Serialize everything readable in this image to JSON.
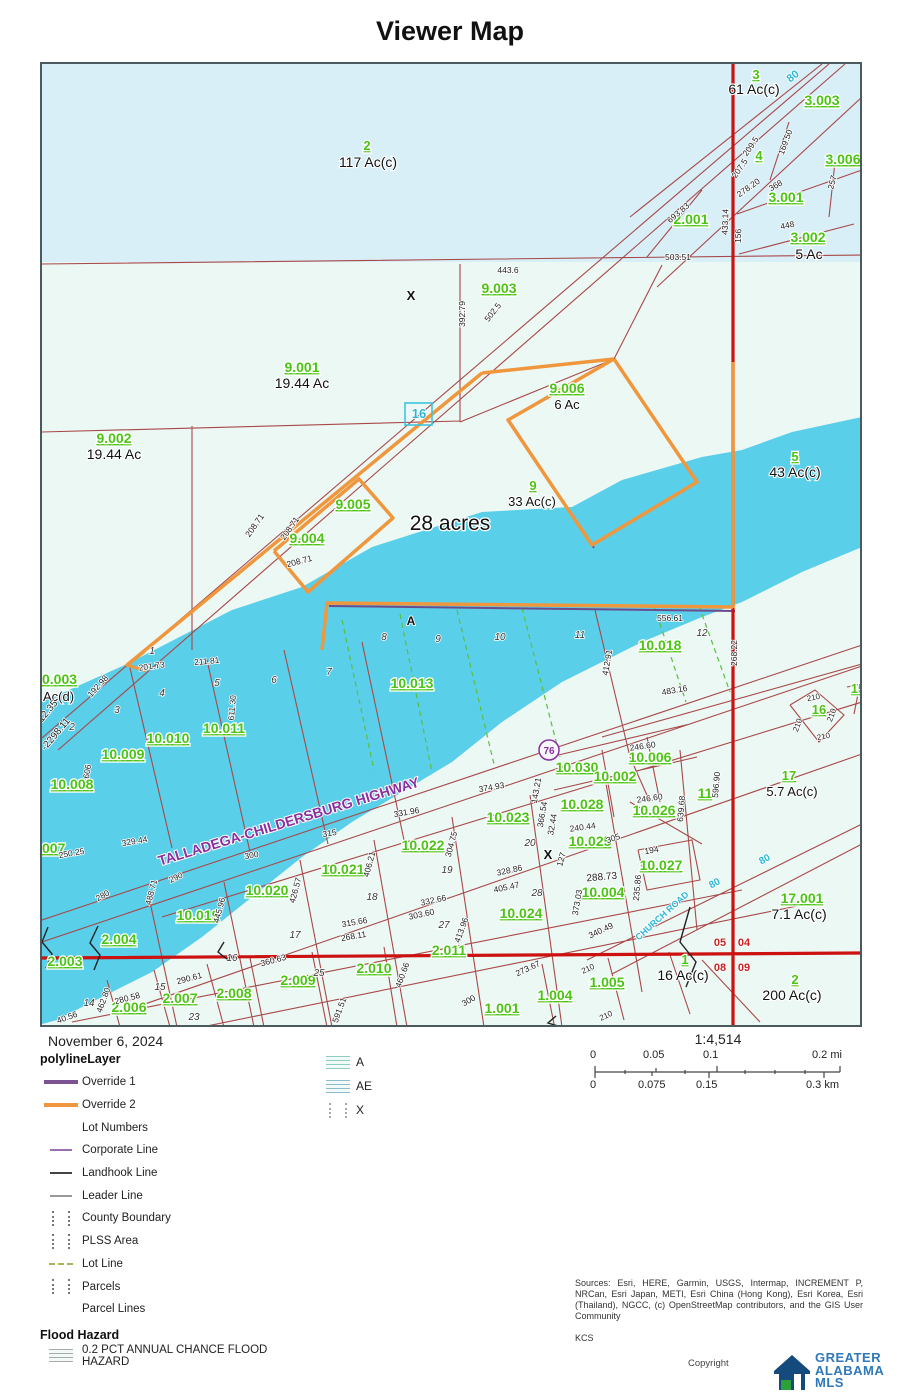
{
  "title": "Viewer Map",
  "map": {
    "colors": {
      "water": "#59cfea",
      "land": "#ecf8f4",
      "land_top": "#d9eff8",
      "parcel_line": "#a84848",
      "road_red": "#cc1111",
      "override1": "#6b4d8e",
      "override2": "#f0963c",
      "lot_line_green": "#5abf3f",
      "label_green": "#4cc414",
      "road_label_cyan": "#29b6d8",
      "highway_label_purple": "#8b2fa0"
    },
    "labels": [
      [
        "3",
        754,
        77,
        "g",
        13
      ],
      [
        "3.003",
        820,
        103,
        "g",
        14
      ],
      [
        "2",
        365,
        148,
        "g",
        13
      ],
      [
        "4",
        757,
        158,
        "g",
        13
      ],
      [
        "3.001",
        784,
        200,
        "g",
        14
      ],
      [
        "2.001",
        689,
        222,
        "g",
        14
      ],
      [
        "3.002",
        806,
        240,
        "g",
        14
      ],
      [
        "3.006",
        841,
        162,
        "g",
        14
      ],
      [
        "9.003",
        497,
        291,
        "g",
        14
      ],
      [
        "9.001",
        300,
        370,
        "g",
        14
      ],
      [
        "9.002",
        112,
        441,
        "g",
        14
      ],
      [
        "9.006",
        565,
        391,
        "g",
        14
      ],
      [
        "9.005",
        351,
        507,
        "g",
        14
      ],
      [
        "9.004",
        305,
        541,
        "g",
        14
      ],
      [
        "9",
        531,
        488,
        "g",
        13
      ],
      [
        "5",
        793,
        459,
        "g",
        13
      ],
      [
        "0.003",
        40,
        682,
        "g",
        14,
        0,
        "s"
      ],
      [
        "007",
        40,
        851,
        "g",
        14,
        0,
        "s"
      ],
      [
        "10.013",
        410,
        686,
        "g",
        14
      ],
      [
        "10.018",
        658,
        648,
        "g",
        14
      ],
      [
        "10.008",
        70,
        787,
        "g",
        14
      ],
      [
        "10.009",
        121,
        757,
        "g",
        14
      ],
      [
        "10.010",
        166,
        741,
        "g",
        14
      ],
      [
        "10.011",
        222,
        731,
        "g",
        14
      ],
      [
        "10.030",
        575,
        770,
        "g",
        14
      ],
      [
        "10.002",
        613,
        779,
        "g",
        14
      ],
      [
        "10.006",
        648,
        760,
        "g",
        14
      ],
      [
        "10.028",
        580,
        807,
        "g",
        14
      ],
      [
        "10.026",
        652,
        813,
        "g",
        14
      ],
      [
        "10.025",
        588,
        844,
        "g",
        14
      ],
      [
        "10.027",
        659,
        868,
        "g",
        14
      ],
      [
        "10.023",
        506,
        820,
        "g",
        14
      ],
      [
        "10.022",
        421,
        848,
        "g",
        14
      ],
      [
        "10.021",
        341,
        872,
        "g",
        14
      ],
      [
        "10.020",
        265,
        893,
        "g",
        14
      ],
      [
        "10.019",
        196,
        918,
        "g",
        14
      ],
      [
        "10.024",
        519,
        916,
        "g",
        14
      ],
      [
        "10.004",
        601,
        895,
        "g",
        14
      ],
      [
        "11",
        703,
        796,
        "g",
        14
      ],
      [
        "17",
        787,
        778,
        "g",
        13
      ],
      [
        "16",
        817,
        712,
        "g",
        13
      ],
      [
        "15",
        856,
        691,
        "g",
        13
      ],
      [
        "17.001",
        800,
        901,
        "g",
        14
      ],
      [
        "2.004",
        117,
        942,
        "g",
        14
      ],
      [
        "2.003",
        63,
        964,
        "g",
        14
      ],
      [
        "2.006",
        127,
        1010,
        "g",
        14
      ],
      [
        "2.007",
        178,
        1001,
        "g",
        14
      ],
      [
        "2.008",
        232,
        996,
        "g",
        14
      ],
      [
        "2.009",
        296,
        983,
        "g",
        14
      ],
      [
        "2.010",
        372,
        971,
        "g",
        14
      ],
      [
        "2.011",
        447,
        953,
        "g",
        14
      ],
      [
        "1.001",
        500,
        1011,
        "g",
        14
      ],
      [
        "1.004",
        553,
        998,
        "g",
        14
      ],
      [
        "1.005",
        605,
        985,
        "g",
        14
      ],
      [
        "1",
        683,
        962,
        "g",
        13
      ],
      [
        "2",
        793,
        982,
        "g",
        13
      ],
      [
        "61 Ac(c)",
        752,
        92,
        "k",
        14
      ],
      [
        "5 Ac",
        807,
        257,
        "k",
        14
      ],
      [
        "117 Ac(c)",
        366,
        165,
        "k",
        14
      ],
      [
        "19.44 Ac",
        300,
        386,
        "k",
        14
      ],
      [
        "19.44 Ac",
        112,
        457,
        "k",
        14
      ],
      [
        "6 Ac",
        565,
        407,
        "k",
        13
      ],
      [
        "33 Ac(c)",
        530,
        504,
        "k",
        13
      ],
      [
        "43 Ac(c)",
        793,
        475,
        "k",
        14
      ],
      [
        "5.7 Ac(c)",
        790,
        794,
        "k",
        13
      ],
      [
        "7.1 Ac(c)",
        797,
        917,
        "k",
        14
      ],
      [
        "16 Ac(c)",
        681,
        978,
        "k",
        14
      ],
      [
        "200 Ac(c)",
        790,
        998,
        "k",
        14
      ],
      [
        "Ac(d)",
        41,
        699,
        "k",
        13,
        0,
        "s"
      ],
      [
        "28 acres",
        448,
        528,
        "b",
        21
      ],
      [
        "X",
        409,
        298,
        "x",
        13
      ],
      [
        "X",
        546,
        857,
        "x",
        13
      ],
      [
        "A",
        409,
        623,
        "x",
        12
      ],
      [
        "443.6",
        506,
        271,
        "d",
        8.5
      ],
      [
        "503.51",
        676,
        258,
        "d",
        8.5
      ],
      [
        "392.79",
        463,
        312,
        "d",
        8.5,
        -90
      ],
      [
        "502.5",
        493,
        312,
        "d",
        8.5,
        -52
      ],
      [
        "433.14",
        726,
        220,
        "d",
        8.5,
        -88
      ],
      [
        "156",
        739,
        234,
        "d",
        8.5,
        -88
      ],
      [
        "207.5",
        740,
        168,
        "d",
        8.5,
        -55
      ],
      [
        "209.5",
        751,
        146,
        "d",
        8.5,
        -55
      ],
      [
        "169.50",
        786,
        141,
        "d",
        8.5,
        -70
      ],
      [
        "278.20",
        748,
        188,
        "d",
        8.5,
        -35
      ],
      [
        "368",
        775,
        186,
        "d",
        8.5,
        -30
      ],
      [
        "257",
        833,
        181,
        "d",
        8.5,
        -75
      ],
      [
        "448",
        786,
        226,
        "d",
        8.5,
        -12
      ],
      [
        "693.83",
        678,
        213,
        "d",
        8.5,
        -40
      ],
      [
        "208.71",
        255,
        525,
        "d",
        8.5,
        -55
      ],
      [
        "208.71",
        290,
        528,
        "d",
        8.5,
        -55
      ],
      [
        "208.71",
        298,
        562,
        "d",
        8.5,
        -15
      ],
      [
        "556.61",
        668,
        619,
        "d",
        8.5
      ],
      [
        "412.91",
        608,
        661,
        "d",
        8.5,
        -80
      ],
      [
        "483.16",
        673,
        691,
        "d",
        8.5,
        -10
      ],
      [
        "268.22",
        735,
        651,
        "d",
        8.5,
        -90
      ],
      [
        "246.60",
        641,
        747,
        "d",
        8.5,
        -8
      ],
      [
        "246.60",
        648,
        799,
        "d",
        8.5,
        -8
      ],
      [
        "143.21",
        537,
        789,
        "d",
        8.5,
        -80
      ],
      [
        "366.54",
        543,
        813,
        "d",
        8.5,
        -80
      ],
      [
        "32.44",
        553,
        823,
        "d",
        8.5,
        -80
      ],
      [
        "240.44",
        581,
        828,
        "d",
        8.5,
        -8
      ],
      [
        "305",
        612,
        839,
        "d",
        8.5,
        -20
      ],
      [
        "127",
        562,
        858,
        "d",
        8.5,
        -75
      ],
      [
        "194",
        650,
        851,
        "d",
        8.5,
        -10
      ],
      [
        "235.86",
        638,
        886,
        "d",
        8.5,
        -85
      ],
      [
        "288.73",
        600,
        878,
        "d",
        10,
        -5
      ],
      [
        "639.68",
        682,
        807,
        "d",
        8.5,
        -85
      ],
      [
        "596.90",
        717,
        783,
        "d",
        8.5,
        -85
      ],
      [
        "211.81",
        205,
        662,
        "d",
        8.5,
        -5
      ],
      [
        "201.73",
        150,
        667,
        "d",
        8.5,
        -8
      ],
      [
        "192.98",
        98,
        686,
        "d",
        8.5,
        -48
      ],
      [
        "611.30",
        233,
        706,
        "d",
        8.5,
        -85
      ],
      [
        "606",
        88,
        770,
        "d",
        8.5,
        -80
      ],
      [
        "329.44",
        133,
        842,
        "d",
        8.5,
        -10
      ],
      [
        "250.25",
        70,
        854,
        "d",
        8.5,
        -10
      ],
      [
        "280",
        102,
        896,
        "d",
        8.5,
        -30
      ],
      [
        "290",
        175,
        878,
        "d",
        8.5,
        -25
      ],
      [
        "488.71",
        152,
        891,
        "d",
        8.5,
        -75
      ],
      [
        "445.96",
        220,
        909,
        "d",
        8.5,
        -75
      ],
      [
        "426.57",
        296,
        889,
        "d",
        8.5,
        -75
      ],
      [
        "315",
        328,
        834,
        "d",
        8.5,
        -10
      ],
      [
        "300",
        250,
        856,
        "d",
        8.5,
        -10
      ],
      [
        "315.66",
        353,
        923,
        "d",
        8.5,
        -10
      ],
      [
        "268.11",
        352,
        937,
        "d",
        8.5,
        -10
      ],
      [
        "406.21",
        370,
        863,
        "d",
        8.5,
        -75
      ],
      [
        "331.96",
        405,
        813,
        "d",
        8.5,
        -10
      ],
      [
        "374.93",
        490,
        788,
        "d",
        8.5,
        -10
      ],
      [
        "304.75",
        452,
        843,
        "d",
        8.5,
        -75
      ],
      [
        "332.66",
        432,
        901,
        "d",
        8.5,
        -12
      ],
      [
        "303.60",
        420,
        915,
        "d",
        8.5,
        -12
      ],
      [
        "328.86",
        508,
        871,
        "d",
        8.5,
        -12
      ],
      [
        "405.47",
        505,
        888,
        "d",
        8.5,
        -12
      ],
      [
        "413.96",
        462,
        929,
        "d",
        8.5,
        -70
      ],
      [
        "373.03",
        578,
        901,
        "d",
        8.5,
        -80
      ],
      [
        "340.49",
        600,
        931,
        "d",
        8.5,
        -25
      ],
      [
        "273.67",
        527,
        969,
        "d",
        8.5,
        -25
      ],
      [
        "210",
        587,
        969,
        "d",
        8,
        -25
      ],
      [
        "210",
        605,
        1016,
        "d",
        8,
        -25
      ],
      [
        "210",
        812,
        698,
        "d",
        8,
        -12
      ],
      [
        "210",
        798,
        724,
        "d",
        8,
        -70
      ],
      [
        "210",
        832,
        714,
        "d",
        8,
        -70
      ],
      [
        "210",
        822,
        737,
        "d",
        8,
        -12
      ],
      [
        "300",
        468,
        1001,
        "d",
        8.5,
        -30
      ],
      [
        "460.66",
        403,
        974,
        "d",
        8.5,
        -70
      ],
      [
        "360.63",
        272,
        961,
        "d",
        8.5,
        -15
      ],
      [
        "290.61",
        188,
        979,
        "d",
        8.5,
        -15
      ],
      [
        "280.58",
        126,
        999,
        "d",
        8.5,
        -15
      ],
      [
        "462.80",
        104,
        999,
        "d",
        8.5,
        -70
      ],
      [
        "591.51",
        340,
        1009,
        "d",
        8.5,
        -70
      ],
      [
        "40.56",
        66,
        1018,
        "d",
        8.5,
        -20
      ],
      [
        "12.35",
        48,
        711,
        "d",
        10,
        -50
      ],
      [
        "-2298.11",
        56,
        734,
        "d",
        10,
        -50
      ],
      [
        "1",
        150,
        652,
        "i",
        10
      ],
      [
        "2",
        70,
        728,
        "i",
        10
      ],
      [
        "3",
        115,
        711,
        "i",
        10
      ],
      [
        "4",
        160,
        694,
        "i",
        10
      ],
      [
        "5",
        215,
        684,
        "i",
        10
      ],
      [
        "6",
        272,
        681,
        "i",
        10
      ],
      [
        "7",
        327,
        673,
        "i",
        10
      ],
      [
        "8",
        382,
        638,
        "i",
        10
      ],
      [
        "9",
        436,
        640,
        "i",
        10
      ],
      [
        "10",
        498,
        638,
        "i",
        10
      ],
      [
        "11",
        578,
        636,
        "i",
        10
      ],
      [
        "12",
        700,
        634,
        "i",
        10
      ],
      [
        "14",
        87,
        1004,
        "i",
        10
      ],
      [
        "15",
        158,
        988,
        "i",
        10
      ],
      [
        "16",
        230,
        959,
        "i",
        10
      ],
      [
        "17",
        293,
        936,
        "i",
        10
      ],
      [
        "18",
        370,
        898,
        "i",
        10
      ],
      [
        "19",
        445,
        871,
        "i",
        10
      ],
      [
        "20",
        528,
        844,
        "i",
        10
      ],
      [
        "23",
        192,
        1018,
        "i",
        10
      ],
      [
        "25",
        317,
        974,
        "i",
        10
      ],
      [
        "27",
        442,
        926,
        "i",
        10
      ],
      [
        "28",
        535,
        894,
        "i",
        10
      ],
      [
        "05",
        718,
        944,
        "r",
        11
      ],
      [
        "04",
        742,
        944,
        "r",
        11
      ],
      [
        "08",
        718,
        969,
        "r",
        11
      ],
      [
        "09",
        742,
        969,
        "r",
        11
      ],
      [
        "16",
        417,
        416,
        "c",
        13
      ],
      [
        "80",
        793,
        77,
        "c",
        11,
        -38
      ],
      [
        "80",
        714,
        884,
        "c",
        10,
        -28
      ],
      [
        "80",
        764,
        860,
        "c",
        10,
        -28
      ],
      [
        "CHURCH ROAD",
        662,
        916,
        "c",
        9,
        -42
      ],
      [
        "TALLADEGA-CHILDERSBURG HIGHWAY",
        288,
        824,
        "p",
        14,
        -17
      ],
      [
        "76",
        547,
        752,
        "m",
        10
      ]
    ]
  },
  "legend": {
    "layer_title": "polylineLayer",
    "items": [
      {
        "label": "Override 1",
        "swatch": "thick",
        "color": "#7a5390"
      },
      {
        "label": "Override 2",
        "swatch": "thick",
        "color": "#f0963c"
      },
      {
        "label": "Lot Numbers",
        "swatch": "none",
        "color": ""
      },
      {
        "label": "Corporate Line",
        "swatch": "thin",
        "color": "#9a6fae"
      },
      {
        "label": "Landhook Line",
        "swatch": "thin",
        "color": "#444444"
      },
      {
        "label": "Leader Line",
        "swatch": "thin",
        "color": "#999999"
      },
      {
        "label": "County Boundary",
        "swatch": "dots",
        "color": "#777777"
      },
      {
        "label": "PLSS Area",
        "swatch": "dots",
        "color": "#777777"
      },
      {
        "label": "Lot Line",
        "swatch": "dash",
        "color": "#a9b25c"
      },
      {
        "label": "Parcels",
        "swatch": "dots",
        "color": "#777777"
      },
      {
        "label": "Parcel Lines",
        "swatch": "none",
        "color": ""
      }
    ],
    "flood_title": "Flood Hazard",
    "flood_items": [
      {
        "label": "0.2 PCT ANNUAL CHANCE FLOOD HAZARD",
        "swatch": "stripes",
        "color": "#aaaaaa"
      }
    ],
    "zones": [
      {
        "label": "A",
        "swatch": "stripes",
        "color": "#8fccc4"
      },
      {
        "label": "AE",
        "swatch": "stripes",
        "color": "#8fbccc"
      },
      {
        "label": "X",
        "swatch": "dots",
        "color": "#aaaaaa"
      }
    ]
  },
  "footer": {
    "date": "November 6, 2024",
    "ratio": "1:4,514",
    "mi_labels": [
      "0",
      "0.05",
      "0.1",
      "0.2 mi"
    ],
    "km_labels": [
      "0",
      "0.075",
      "0.15",
      "0.3 km"
    ],
    "sources": "Sources: Esri, HERE, Garmin, USGS, Intermap, INCREMENT P, NRCan, Esri Japan, METI, Esri China (Hong Kong), Esri Korea, Esri (Thailand), NGCC, (c) OpenStreetMap contributors, and the GIS User Community",
    "sources2": "KCS",
    "copyright": "Copyright",
    "logo_lines": [
      "GREATER",
      "ALABAMA",
      "MLS"
    ]
  }
}
